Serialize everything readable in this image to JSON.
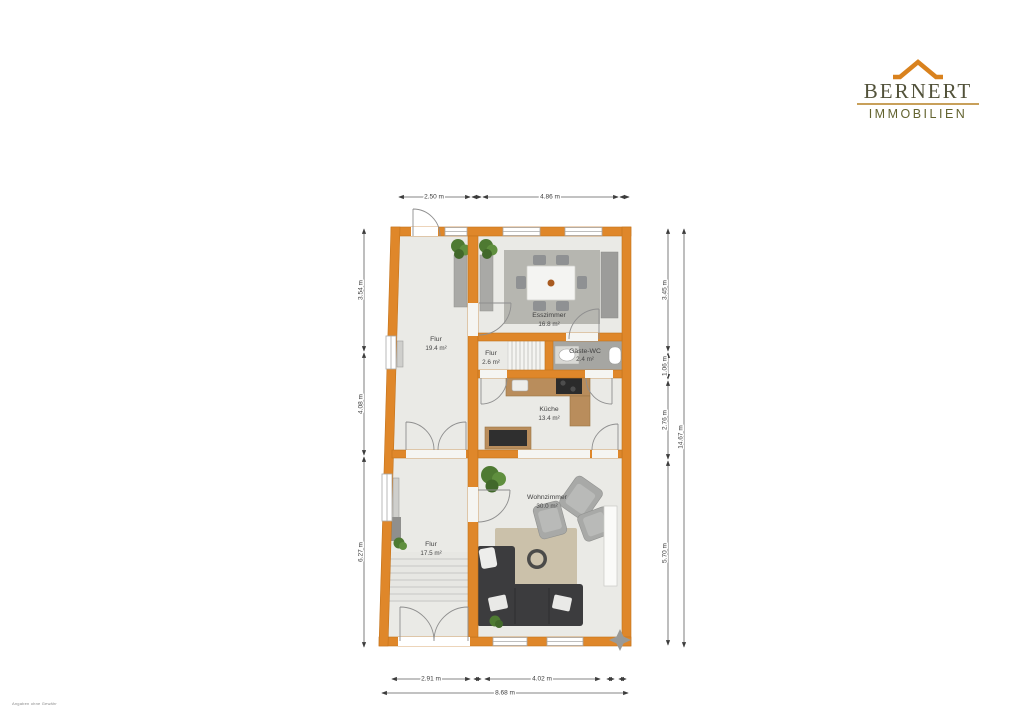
{
  "logo": {
    "name": "BERNERT",
    "tagline": "IMMOBILIEN"
  },
  "footer": {
    "disclaimer": "Angaben ohne Gewähr"
  },
  "floor_plan": {
    "rooms": {
      "flur_top": {
        "name": "Flur",
        "area": "19.4 m²"
      },
      "esszimmer": {
        "name": "Esszimmer",
        "area": "16.8 m²"
      },
      "flur_mid": {
        "name": "Flur",
        "area": "2.6 m²"
      },
      "gaeste_wc": {
        "name": "Gäste-WC",
        "area": "2.4 m²"
      },
      "kueche": {
        "name": "Küche",
        "area": "13.4 m²"
      },
      "wohnzimmer": {
        "name": "Wohnzimmer",
        "area": "30.0 m²"
      },
      "flur_bottom": {
        "name": "Flur",
        "area": "17.5 m²"
      }
    },
    "dimensions": {
      "top": [
        "2.50 m",
        "4.86 m"
      ],
      "left": [
        "3.54 m",
        "4.08 m",
        "6.27 m"
      ],
      "right": [
        "3.45 m",
        "1.06 m",
        "2.76 m",
        "5.70 m"
      ],
      "right_total": "14.67 m",
      "bottom": [
        "2.91 m",
        "4.02 m"
      ],
      "bottom_total": "8.68 m"
    },
    "colors": {
      "wall": "#DF872A",
      "floor": "#EAEAE6",
      "wood": "#B98D5C",
      "logo_accent": "#D9821E"
    }
  }
}
